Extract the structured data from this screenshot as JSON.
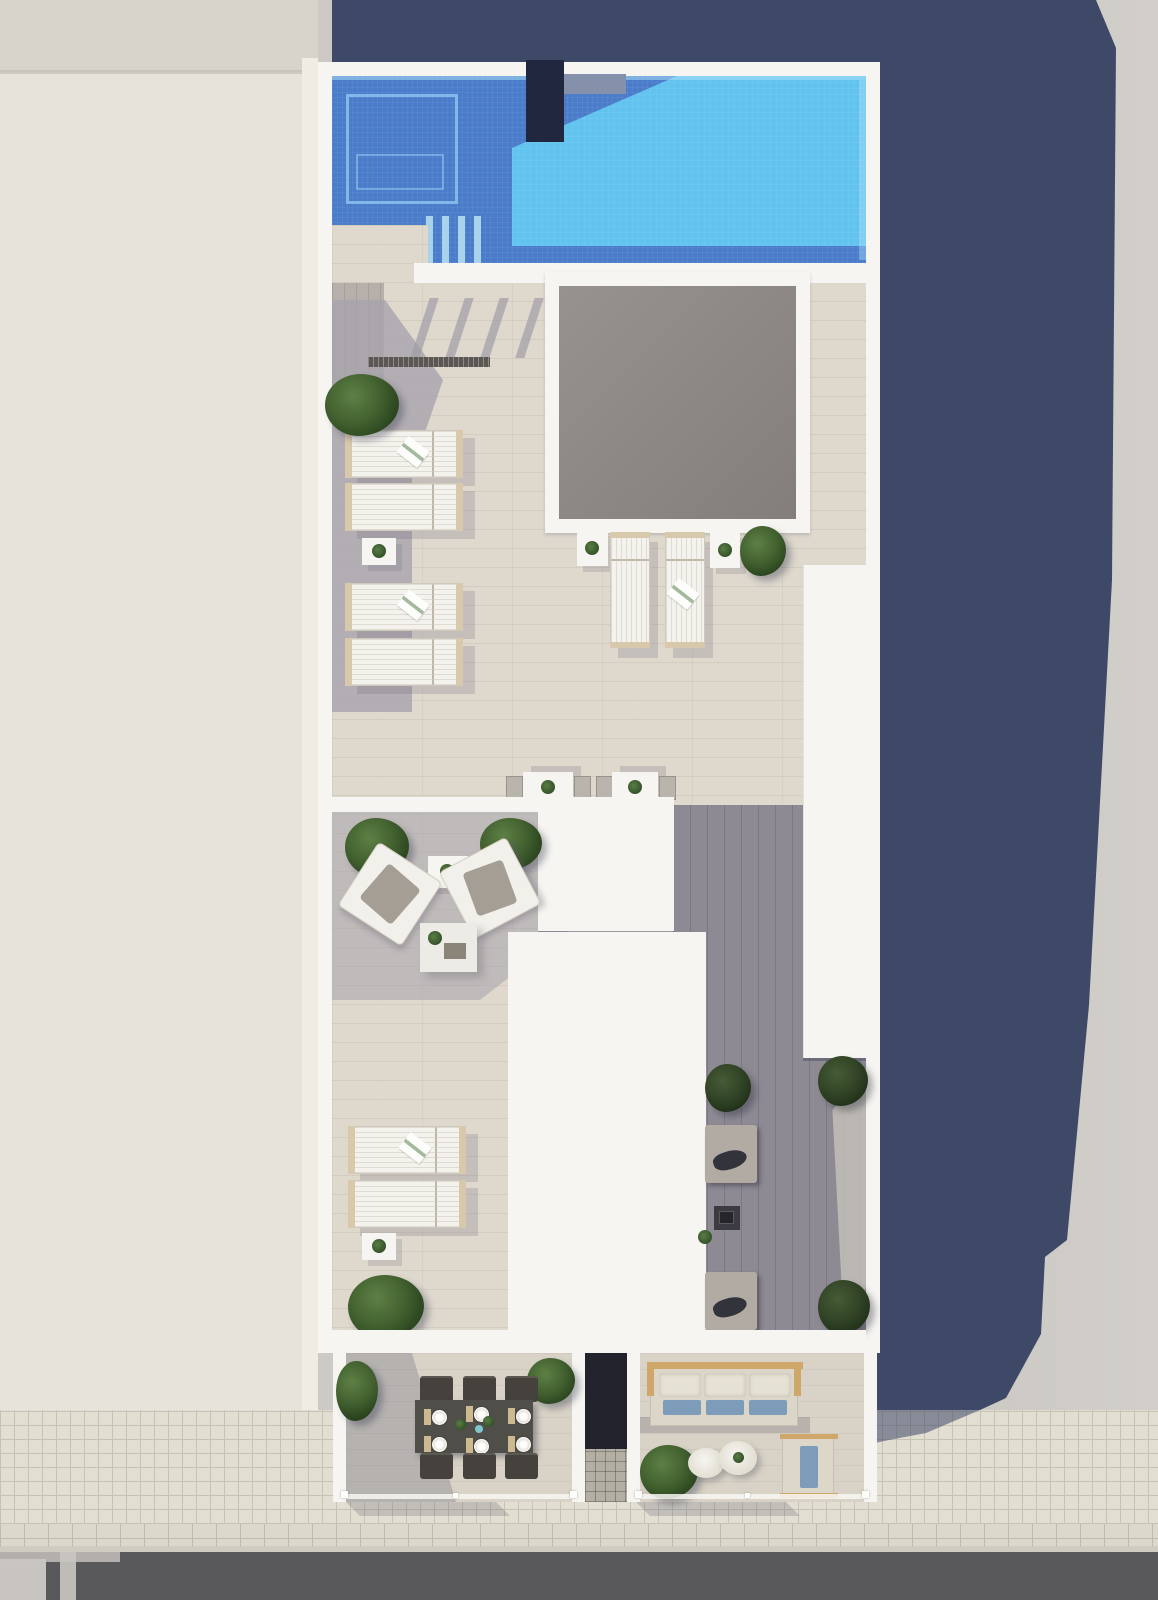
{
  "scene": {
    "title": "Aerial 3D architectural render of a rooftop pool terrace building between an adjacent roof and a street",
    "view": "top-down plan render, no visible text labels",
    "areas": {
      "pool_zone": {
        "label": "Swimming pool with submerged platform, steps and chimney block"
      },
      "skylight": {
        "label": "Large square skylight opening in pool deck"
      },
      "upper_terrace": {
        "label": "Sun deck with four loungers left and two loungers below skylight"
      },
      "bistro": {
        "label": "Two bistro tables with two chairs each"
      },
      "lounge": {
        "label": "Lounge corner with two angled armchairs, side table and coffee table"
      },
      "lower_deck": {
        "label": "Lower deck with two loungers, side table and shrub"
      },
      "fire_lounge": {
        "label": "Shaded lounge with two sofas and fire-pit table"
      },
      "roof_slabs": {
        "label": "White roof slabs and tall service wall"
      },
      "balcony_dining": {
        "label": "Street balcony with dining table, six chairs and six place settings"
      },
      "balcony_sofa": {
        "label": "Street balcony with wood-frame sofa, two round tables and armchair"
      },
      "street": {
        "label": "Tiled sidewalk and asphalt road with lane markings"
      },
      "shadow": {
        "label": "Long building shadow cast to the right"
      }
    },
    "counts": {
      "sun_loungers": 8,
      "bushes": 13,
      "side_tables": 5,
      "bistro_sets": 2,
      "dining_seats": 6,
      "place_settings": 6,
      "sofas": 3,
      "armchairs": 3,
      "round_tables": 2
    }
  },
  "palette": {
    "bg_right": "#cdc9c4",
    "left_roof": "#e7e3da",
    "left_roof_top": "#d8d4cb",
    "shadow_navy": "#3e4967",
    "white": "#f6f5f1",
    "deck": "#ded8cd",
    "deck_shadow": "#a8a4ad",
    "deck_dark": "#8e8a94",
    "pool_light": "#62c3ee",
    "pool_dark": "#4a7cca",
    "pool_step": "#a9d3ea",
    "chimney": "#222740",
    "skylight_a": "#97928f",
    "skylight_b": "#837e7b",
    "bush_a": "#5e8045",
    "bush_b": "#2c4620",
    "wood_tan": "#cfa76b",
    "cushion_blue": "#7d9cba",
    "cushion_dark": "#33333c",
    "table_dark": "#4f4e49",
    "chair_dark": "#45423d",
    "sidewalk": "#e2ded2",
    "sidewalk_line": "#c6c2b4",
    "road": "#59585b",
    "furn_white": "#f4f2ed",
    "furn_frame": "#d8c9ad",
    "sofa_gray": "#b1aba4"
  }
}
